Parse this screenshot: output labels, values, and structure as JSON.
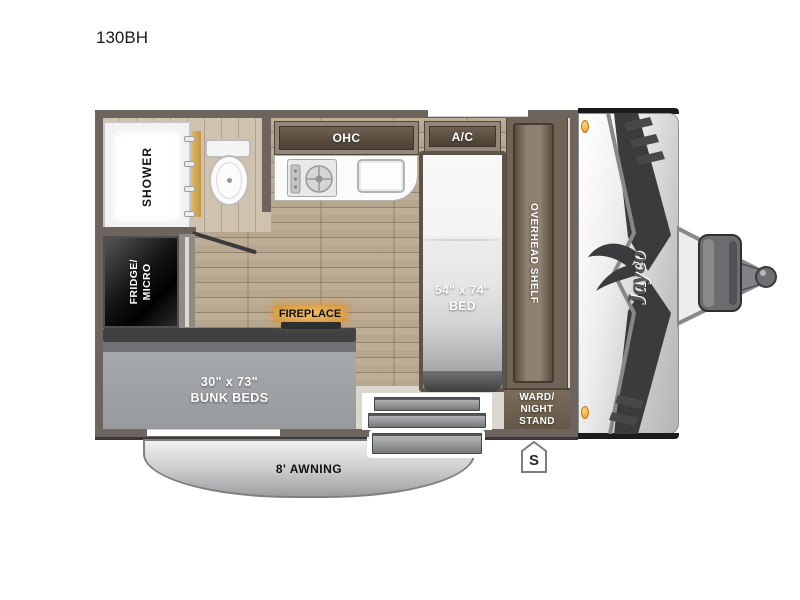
{
  "title": "130BH",
  "brand": {
    "name": "Jayco"
  },
  "floorplan": {
    "labels": {
      "shower": "SHOWER",
      "fridge_micro": "FRIDGE/\nMICRO",
      "ohc": "OHC",
      "ac": "A/C",
      "bed_size": "54\" x 74\"",
      "bed": "BED",
      "overhead_shelf": "OVERHEAD SHELF",
      "ward_night_stand": "WARD/\nNIGHT\nSTAND",
      "bunk_size": "30\" x 73\"",
      "bunk_beds": "BUNK BEDS",
      "fireplace": "FIREPLACE",
      "awning": "8' AWNING",
      "spare_badge": "S"
    },
    "colors": {
      "wall": "#6d645d",
      "wood_floor": "#b8a78f",
      "vinyl_floor": "#dbd7cf",
      "cabinet_dark": "#55493c",
      "mattress_gray": "#9ca0a3",
      "marker_light_orange": "#f2a93e",
      "fireplace_glow": "#e0a851",
      "graphic_dark": "#3a3b3d"
    }
  }
}
